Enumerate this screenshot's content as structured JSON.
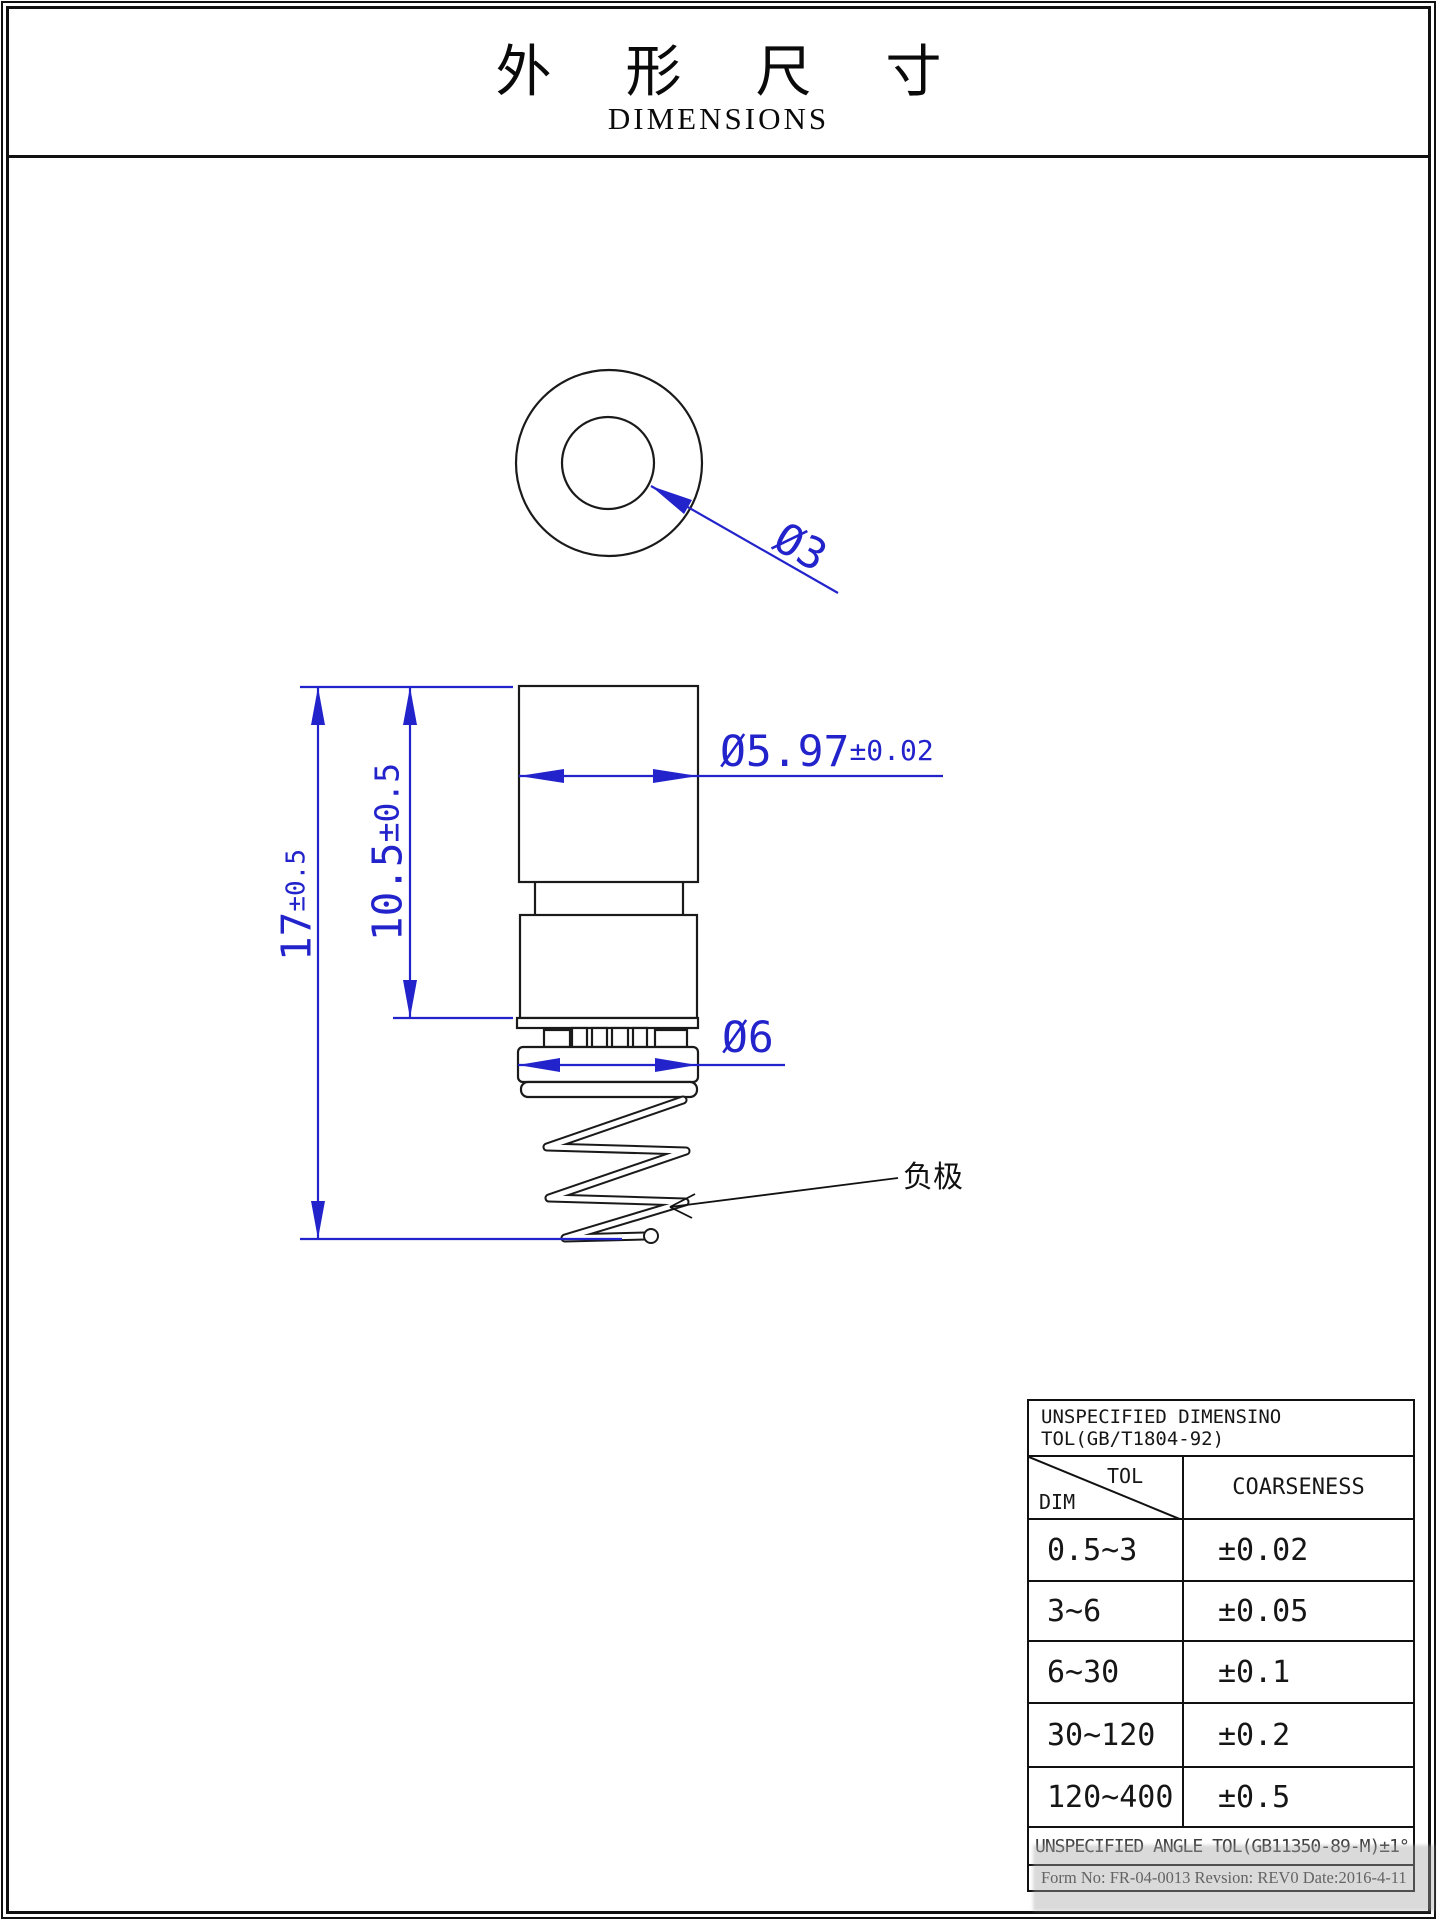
{
  "title": {
    "zh": "外 形 尺 寸",
    "en": "DIMENSIONS"
  },
  "drawing": {
    "labels": {
      "inner_diameter": "Ø3",
      "body_diameter": "Ø5.97",
      "body_diameter_tol": "±0.02",
      "flange_diameter": "Ø6",
      "total_height": "17",
      "total_height_tol": "±0.5",
      "body_height": "10.5",
      "body_height_tol": "±0.5",
      "negative_terminal": "负极"
    },
    "colors": {
      "dimension_blue": "#2323cc",
      "line_black": "#1a1a1a"
    }
  },
  "table": {
    "title": "UNSPECIFIED DIMENSINO TOL(GB/T1804-92)",
    "header": {
      "tol": "TOL",
      "dim": "DIM",
      "coarseness": "COARSENESS"
    },
    "rows": [
      {
        "dim": "0.5~3",
        "tol": "±0.02"
      },
      {
        "dim": "3~6",
        "tol": "±0.05"
      },
      {
        "dim": "6~30",
        "tol": "±0.1"
      },
      {
        "dim": "30~120",
        "tol": "±0.2"
      },
      {
        "dim": "120~400",
        "tol": "±0.5"
      }
    ],
    "angle_note": "UNSPECIFIED ANGLE TOL(GB11350-89-M)±1°",
    "form_info": "Form No: FR-04-0013 Revsion: REV0  Date:2016-4-11"
  }
}
